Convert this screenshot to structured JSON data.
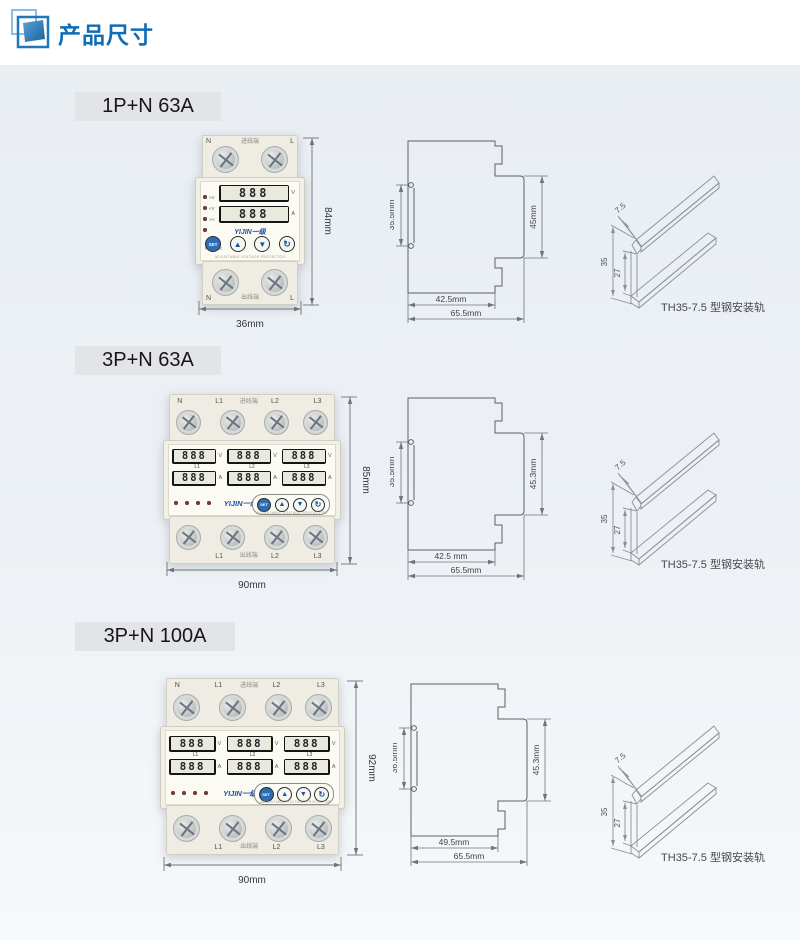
{
  "header": {
    "title": "产品尺寸",
    "accent_color": "#0f6cb5",
    "brand_color": "#1d52a8"
  },
  "sections": [
    {
      "label": "1P+N 63A",
      "device": {
        "top_terminals": [
          "N",
          "L"
        ],
        "bottom_terminals": [
          "N",
          "L"
        ],
        "inlet": "进线端",
        "outlet": "出线端",
        "leds": [
          ">V",
          "<V",
          ">A",
          "POWER"
        ],
        "digits": "888",
        "units": [
          "V",
          "A"
        ],
        "brand": "YIJIN一级",
        "fineprint": "ADJUSTABLE VOLTAGE PROTECTOR",
        "buttons": [
          "SET",
          "▲",
          "▼",
          "↻"
        ],
        "width_dim": "36mm",
        "height_dim": "84mm"
      },
      "side": {
        "left_dim": "35.5mm",
        "right_dim": "45mm",
        "bottom_inner": "42.5mm",
        "bottom_outer": "65.5mm"
      },
      "rail": {
        "lip_dim": "7.5",
        "height_dim": "35",
        "inner_dim": "27",
        "caption": "TH35-7.5 型钢安装轨"
      }
    },
    {
      "label": "3P+N 63A",
      "device": {
        "top_terminals": [
          "N",
          "L1",
          "L2",
          "L3"
        ],
        "bottom_terminals": [
          "",
          "L1",
          "L2",
          "L3"
        ],
        "phases": [
          "L1",
          "L2",
          "L3"
        ],
        "inlet": "进线端",
        "outlet": "出线端",
        "digits": "888",
        "units": [
          "V",
          "A"
        ],
        "brand": "YIJIN一级",
        "fineprint": "ADJUSTABLE VOLTAGE PROTECTOR",
        "buttons": [
          "SET",
          "▲",
          "▼",
          "↻"
        ],
        "width_dim": "90mm",
        "height_dim": "85mm"
      },
      "side": {
        "left_dim": "35.5mm",
        "right_dim": "45.3mm",
        "bottom_inner": "42.5 mm",
        "bottom_outer": "65.5mm"
      },
      "rail": {
        "lip_dim": "7.5",
        "height_dim": "35",
        "inner_dim": "27",
        "caption": "TH35-7.5 型钢安装轨"
      }
    },
    {
      "label": "3P+N 100A",
      "device": {
        "top_terminals": [
          "N",
          "L1",
          "L2",
          "L3"
        ],
        "bottom_terminals": [
          "",
          "L1",
          "L2",
          "L3"
        ],
        "phases": [
          "L1",
          "L2",
          "L3"
        ],
        "inlet": "进线端",
        "outlet": "出线端",
        "digits": "888",
        "units": [
          "V",
          "A"
        ],
        "brand": "YIJIN一级",
        "fineprint": "ADJUSTABLE VOLTAGE PROTECTOR",
        "buttons": [
          "SET",
          "▲",
          "▼",
          "↻"
        ],
        "width_dim": "90mm",
        "height_dim": "92mm"
      },
      "side": {
        "left_dim": "36.5mm",
        "right_dim": "45.3mm",
        "bottom_inner": "49.5mm",
        "bottom_outer": "65.5mm"
      },
      "rail": {
        "lip_dim": "7.5",
        "height_dim": "35",
        "inner_dim": "27",
        "caption": "TH35-7.5 型钢安装轨"
      }
    }
  ]
}
